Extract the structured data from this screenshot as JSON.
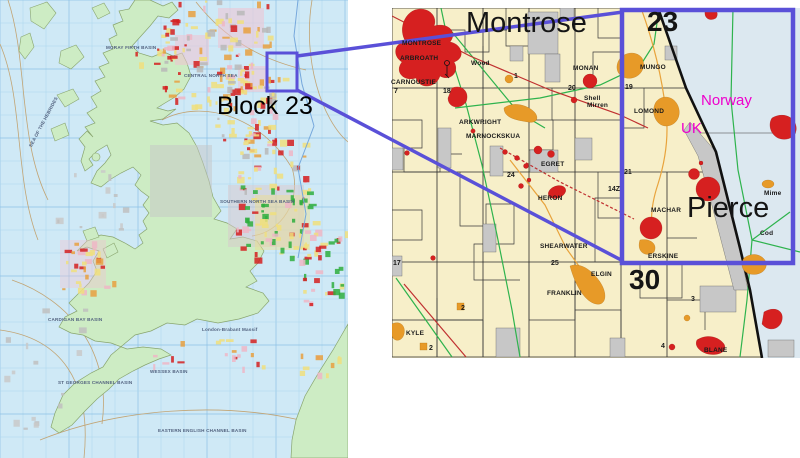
{
  "highlight_color": "#5a50d8",
  "left_map": {
    "callout_label": "Block 23",
    "region_labels": [
      {
        "text": "MORAY FIRTH BASIN",
        "x": 106,
        "y": 46
      },
      {
        "text": "CENTRAL NORTH SEA",
        "x": 184,
        "y": 74
      },
      {
        "text": "SOUTHERN NORTH SEA BASIN",
        "x": 220,
        "y": 200
      },
      {
        "text": "SEA OF THE HEBRIDES",
        "x": 16,
        "y": 120,
        "rot": -62
      },
      {
        "text": "CARDIGAN BAY BASIN",
        "x": 48,
        "y": 318
      },
      {
        "text": "ST GEORGES CHANNEL BASIN",
        "x": 58,
        "y": 381
      },
      {
        "text": "WESSEX BASIN",
        "x": 150,
        "y": 370
      },
      {
        "text": "London-Brabant Massif",
        "x": 202,
        "y": 328
      },
      {
        "text": "EASTERN ENGLISH CHANNEL BASIN",
        "x": 158,
        "y": 429
      }
    ]
  },
  "inset_map": {
    "big_labels": [
      {
        "text": "Montrose",
        "x": 466,
        "y": 9
      },
      {
        "text": "Pierce",
        "x": 687,
        "y": 194
      }
    ],
    "block_quads": [
      {
        "text": "23",
        "x": 647,
        "y": 8
      },
      {
        "text": "30",
        "x": 629,
        "y": 266
      }
    ],
    "country_labels": [
      {
        "text": "Norway",
        "x": 701,
        "y": 93
      },
      {
        "text": "UK",
        "x": 681,
        "y": 121
      }
    ],
    "field_labels": [
      {
        "text": "MONTROSE",
        "x": 402,
        "y": 41
      },
      {
        "text": "ARBROATH",
        "x": 400,
        "y": 56
      },
      {
        "text": "CARNOUSTIE",
        "x": 391,
        "y": 80
      },
      {
        "text": "Wood",
        "x": 471,
        "y": 61
      },
      {
        "text": "MONAN",
        "x": 573,
        "y": 66
      },
      {
        "text": "EGRET",
        "x": 541,
        "y": 162
      },
      {
        "text": "MUNGO",
        "x": 640,
        "y": 65
      },
      {
        "text": "LOMOND",
        "x": 634,
        "y": 109
      },
      {
        "text": "ARKWRIGHT",
        "x": 459,
        "y": 120
      },
      {
        "text": "MARNOCK",
        "x": 466,
        "y": 134
      },
      {
        "text": "SKUA",
        "x": 501,
        "y": 134
      },
      {
        "text": "HERON",
        "x": 538,
        "y": 196
      },
      {
        "text": "MACHAR",
        "x": 651,
        "y": 208
      },
      {
        "text": "SHEARWATER",
        "x": 540,
        "y": 244
      },
      {
        "text": "ERSKINE",
        "x": 648,
        "y": 254
      },
      {
        "text": "ELGIN",
        "x": 591,
        "y": 272
      },
      {
        "text": "FRANKLIN",
        "x": 547,
        "y": 291
      },
      {
        "text": "KYLE",
        "x": 406,
        "y": 331
      },
      {
        "text": "Cod",
        "x": 760,
        "y": 231
      },
      {
        "text": "Mime",
        "x": 764,
        "y": 191
      },
      {
        "text": "BLANE",
        "x": 704,
        "y": 348
      },
      {
        "text": "Shell",
        "x": 584,
        "y": 96
      },
      {
        "text": "Mirren",
        "x": 587,
        "y": 103
      }
    ],
    "block_numbers": [
      {
        "text": "7",
        "x": 394,
        "y": 88
      },
      {
        "text": "18",
        "x": 443,
        "y": 88
      },
      {
        "text": "20",
        "x": 568,
        "y": 85
      },
      {
        "text": "19",
        "x": 625,
        "y": 84
      },
      {
        "text": "21",
        "x": 624,
        "y": 169
      },
      {
        "text": "24",
        "x": 507,
        "y": 172
      },
      {
        "text": "25",
        "x": 551,
        "y": 260
      },
      {
        "text": "17",
        "x": 393,
        "y": 260
      },
      {
        "text": "1",
        "x": 514,
        "y": 73
      },
      {
        "text": "2",
        "x": 429,
        "y": 345
      },
      {
        "text": "2",
        "x": 461,
        "y": 305
      },
      {
        "text": "4",
        "x": 661,
        "y": 343
      },
      {
        "text": "3",
        "x": 691,
        "y": 296
      },
      {
        "text": "14Z",
        "x": 608,
        "y": 186
      }
    ]
  }
}
